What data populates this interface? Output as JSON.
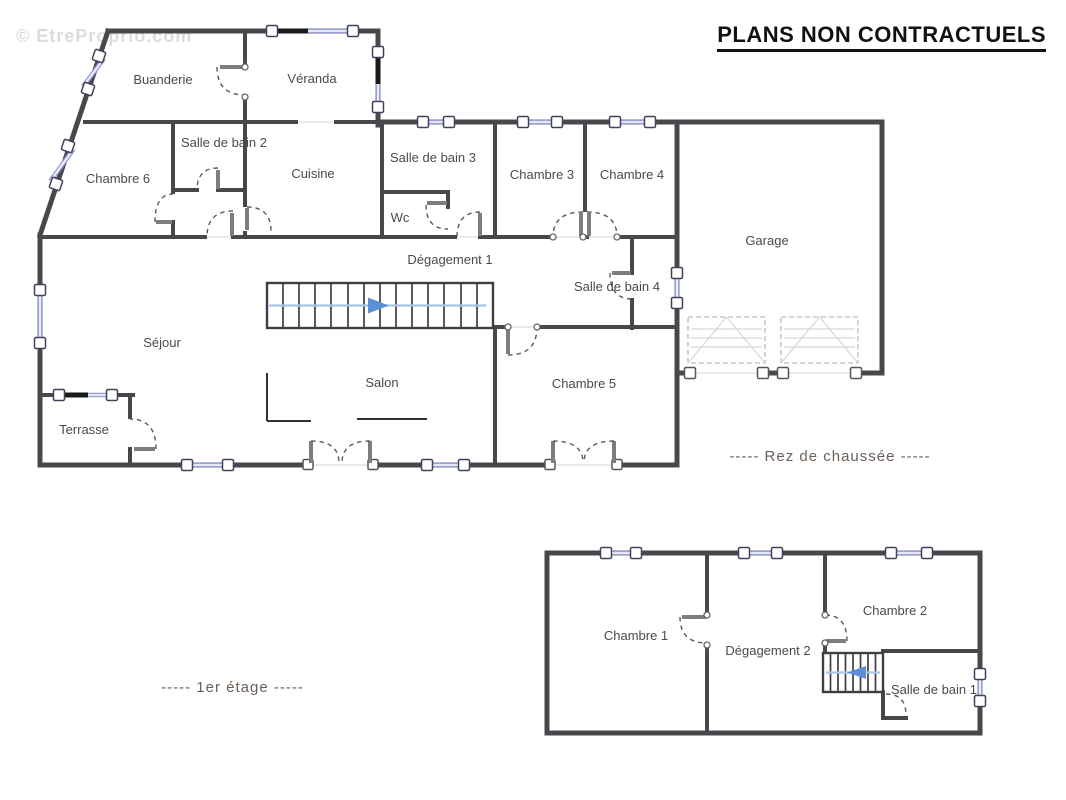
{
  "watermark": "© EtreProprio.com",
  "title": "PLANS NON CONTRACTUELS",
  "colors": {
    "wall": "#48484c",
    "window_frame": "#41415a",
    "window_glass": "#9aa0d8",
    "door_arc": "#5a5a5a",
    "stair_line": "#a9c4e6",
    "stair_arrow": "#5b8fd8",
    "garage_door": "#c8c8c8",
    "text": "#4a4a4a",
    "caption": "#6b5f58",
    "title": "#111111",
    "watermark": "#dcdcdc"
  },
  "ground_floor": {
    "caption": "-----  Rez de chaussée  -----",
    "rooms": [
      {
        "label": "Buanderie"
      },
      {
        "label": "Véranda"
      },
      {
        "label": "Salle de bain 2"
      },
      {
        "label": "Chambre 6"
      },
      {
        "label": "Cuisine"
      },
      {
        "label": "Salle de bain 3"
      },
      {
        "label": "Wc"
      },
      {
        "label": "Chambre 3"
      },
      {
        "label": "Chambre 4"
      },
      {
        "label": "Garage"
      },
      {
        "label": "Dégagement 1"
      },
      {
        "label": "Salle de bain 4"
      },
      {
        "label": "Séjour"
      },
      {
        "label": "Salon"
      },
      {
        "label": "Chambre 5"
      },
      {
        "label": "Terrasse"
      }
    ]
  },
  "first_floor": {
    "caption": "-----  1er étage  -----",
    "rooms": [
      {
        "label": "Chambre 1"
      },
      {
        "label": "Dégagement 2"
      },
      {
        "label": "Chambre 2"
      },
      {
        "label": "Salle de bain 1"
      }
    ]
  }
}
